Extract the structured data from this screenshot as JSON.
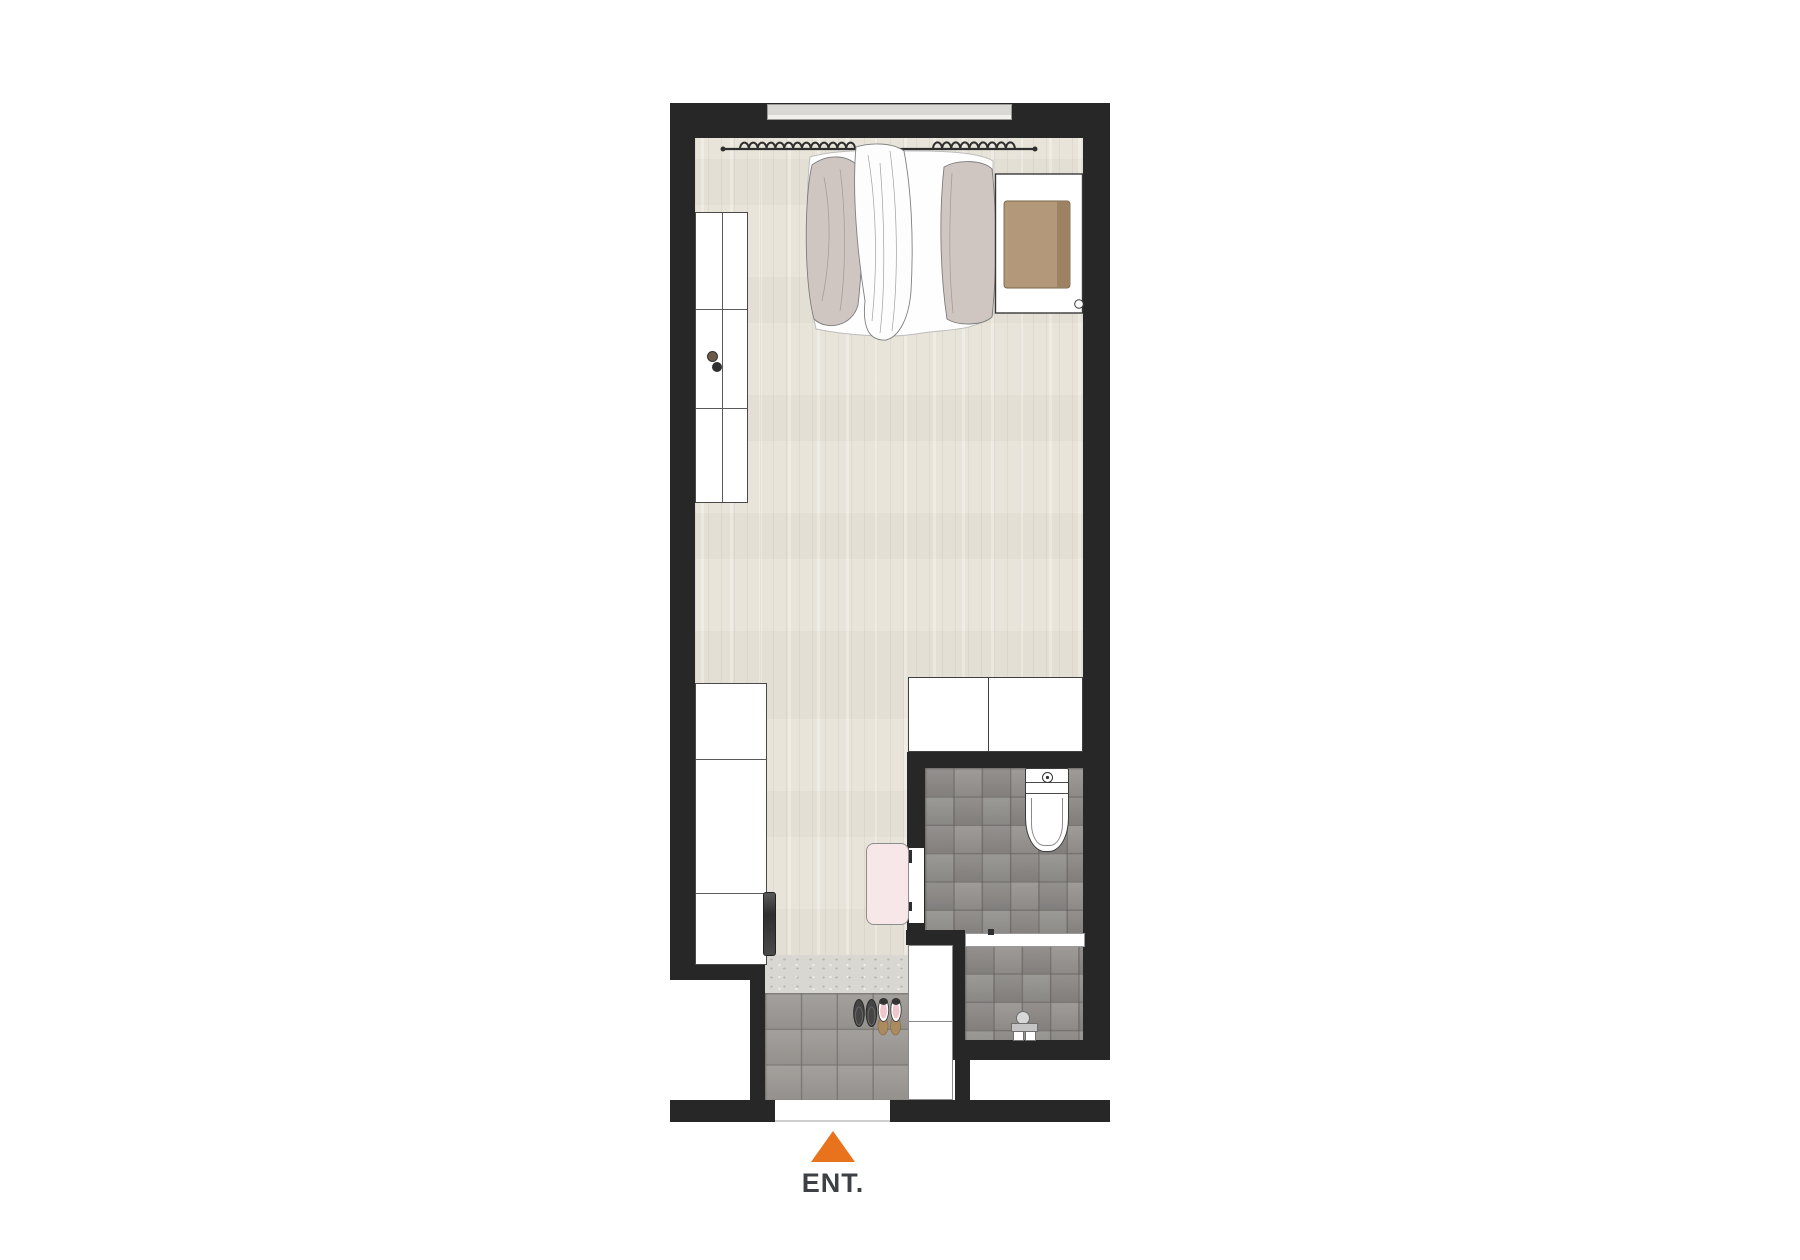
{
  "entrance": {
    "label": "ENT."
  },
  "palette": {
    "wall": "#272727",
    "floor_wood": "#E8E4DA",
    "entry_tile": "#9D9A96",
    "bath_tile": "#918E8B",
    "marble_step": "#D9D7D2",
    "bedding_taupe": "#CFC6C2",
    "headboard_cushion_tan": "#B4987A",
    "bath_mat_pink": "#F8E7E9",
    "entrance_arrow_orange": "#E9731D",
    "label_text": "#3D4146"
  },
  "elements": [
    "window",
    "curtains",
    "bed",
    "duvet",
    "blanket",
    "pillow",
    "headboard-cushion",
    "wardrobe",
    "storage-cabinet",
    "tv",
    "kitchen-counter",
    "bathroom",
    "toilet",
    "shower-screen",
    "shower-faucet",
    "bathroom-door",
    "bath-mat",
    "entry-step",
    "entry-tiles",
    "slippers",
    "shoes",
    "entrance-door",
    "entrance-arrow"
  ]
}
